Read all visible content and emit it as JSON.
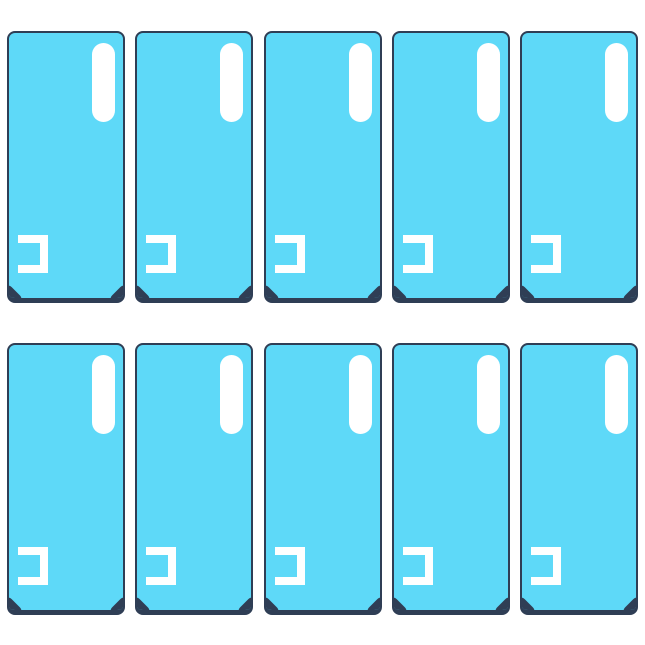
{
  "photo": {
    "subject": "back-cover-adhesive-sticker-set",
    "item_count": 10
  },
  "grid": {
    "rows": 2,
    "columns": 5
  },
  "sticker": {
    "width_px": 118,
    "height_px": 272,
    "features": {
      "camera_pill": "vertical white pill cutout, top-right",
      "alignment_bracket": "left-open white bracket cutout, bottom-left",
      "corner_notches": "dark diagonal notches, bottom corners"
    }
  },
  "colors": {
    "background": "#ffffff",
    "sticker_fill": "#5ed9f8",
    "sticker_border": "#2f3e55",
    "cutout_white": "#ffffff"
  }
}
